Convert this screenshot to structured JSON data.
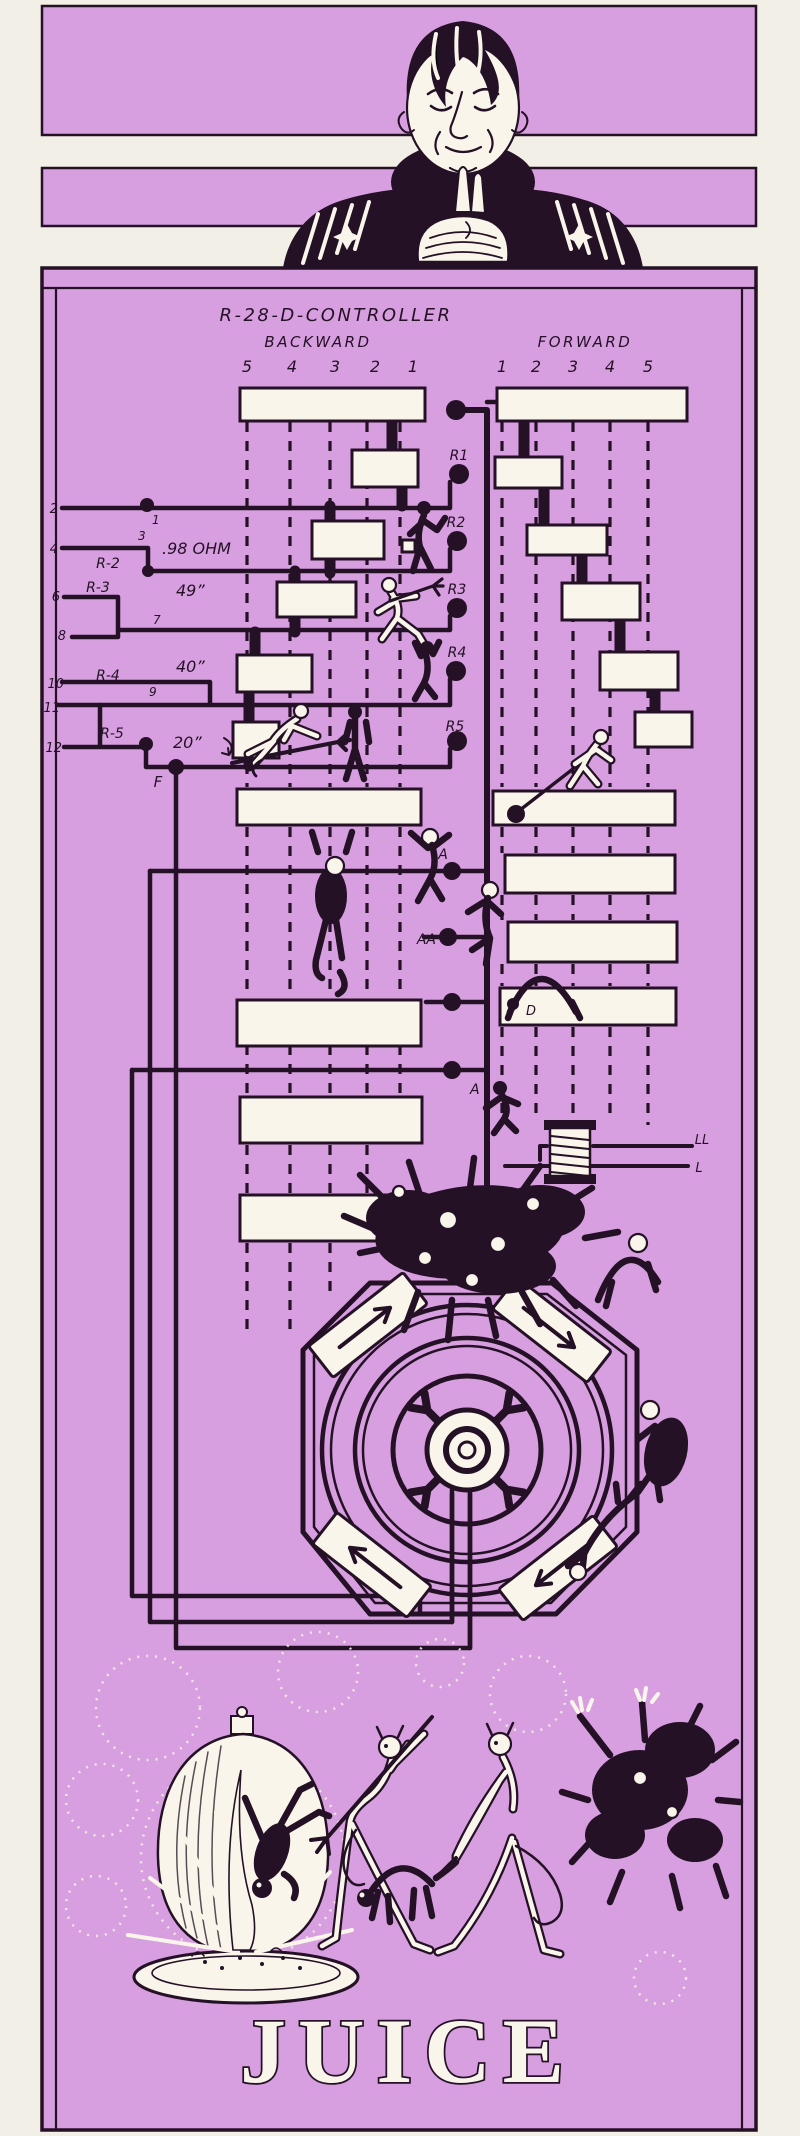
{
  "palette": {
    "paper": "#f2efe6",
    "purple": "#d79fdf",
    "ink": "#241126",
    "white": "#f9f5ea"
  },
  "header": {
    "title": "R-28-D-CONTROLLER",
    "backward_label": "BACKWARD",
    "forward_label": "FORWARD",
    "backward_steps": [
      "5",
      "4",
      "3",
      "2",
      "1"
    ],
    "forward_steps": [
      "1",
      "2",
      "3",
      "4",
      "5"
    ]
  },
  "contacts": {
    "fingers": [
      "R1",
      "R2",
      "R3",
      "R4",
      "R5"
    ],
    "trunk_nodes": {
      "a_upper": "A",
      "aa": "AA",
      "a_lower": "A"
    },
    "bar_label": "D",
    "coil_lines": {
      "ll": "LL",
      "l": "L"
    }
  },
  "resistor_bank": {
    "terminals": [
      "2",
      "4",
      "6",
      "8",
      "10",
      "11",
      "12"
    ],
    "junctions": [
      "1",
      "3",
      "7",
      "9"
    ],
    "resistors": [
      {
        "name": "R-2",
        "value": ".98 OHM"
      },
      {
        "name": "R-3",
        "value": "49”"
      },
      {
        "name": "R-4",
        "value": "40”"
      },
      {
        "name": "R-5",
        "value": "20”"
      }
    ],
    "feed": "F"
  },
  "caption": "JUICE"
}
